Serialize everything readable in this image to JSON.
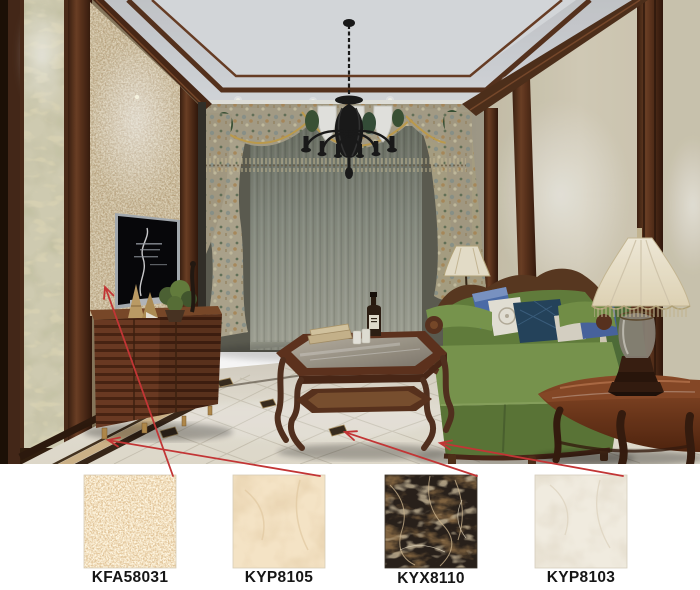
{
  "page": {
    "background": "#ffffff"
  },
  "render": {
    "description": "Classical living-room interior rendering",
    "elements": [
      "coffered ceiling with dark wood trim",
      "black wrought-iron chandelier",
      "patterned valance with white cascades",
      "sheer grey-green center curtain",
      "floral side curtain panels",
      "marble wall panels framed in dark wood",
      "wall-mounted television",
      "slatted wood TV cabinet with plant and figurine",
      "green carved-wood sofa with blue pillows",
      "wood and glass coffee table with books, bottle and cups",
      "demilune wood side table",
      "cream scalloped fabric table lamp",
      "corner floor lamp",
      "beige polished tile floor with dark border band and dark square insets"
    ]
  },
  "swatches": [
    {
      "code": "KFA58031",
      "material": "speckled beige stone tile",
      "base_color": "#f2e0c0",
      "speckle_light": "#fff8e4",
      "speckle_dark": "#dcbc8e",
      "arrow_target": "tv background wall panel"
    },
    {
      "code": "KYP8105",
      "material": "cream marble tile",
      "base_color": "#f4e3c5",
      "vein_color": "#e4cda8",
      "arrow_target": "floor border strip"
    },
    {
      "code": "KYX8110",
      "material": "dark emperador marble tile",
      "base_color": "#28201a",
      "vein_color": "#a07f52",
      "arrow_target": "dark floor inset tile"
    },
    {
      "code": "KYP8103",
      "material": "ivory marble tile",
      "base_color": "#f0ebdf",
      "vein_color": "#ded5c3",
      "arrow_target": "main floor tile"
    }
  ],
  "annotations": {
    "arrow_color": "#c23535",
    "label_color": "#161616"
  }
}
